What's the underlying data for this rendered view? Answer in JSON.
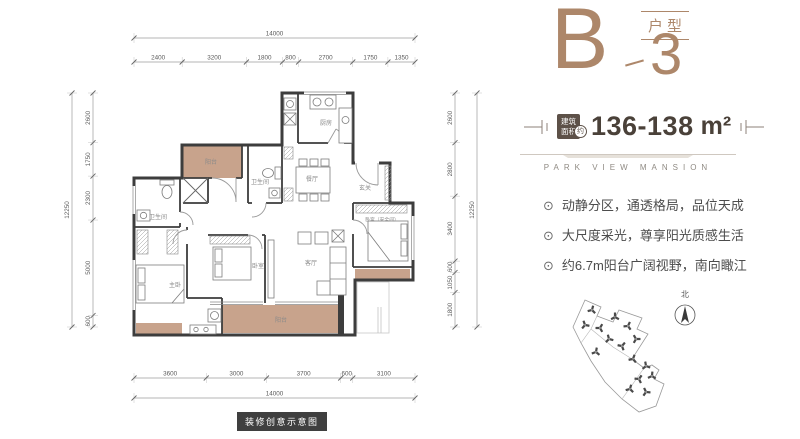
{
  "title": {
    "letter": "B",
    "number": "3",
    "type_label": "户型"
  },
  "area": {
    "badge_line1": "建筑",
    "badge_line2": "面积",
    "approx": "约",
    "value": "136-138",
    "unit": "m²"
  },
  "brand": {
    "name_en": "PARK VIEW MANSION"
  },
  "features": [
    "动静分区，通透格局，品位天成",
    "大尺度采光，尊享阳光质感生活",
    "约6.7m阳台广阔视野，南向瞰江"
  ],
  "icons": {
    "bullet": "⊙"
  },
  "compass": {
    "north_label": "北"
  },
  "footer": {
    "disclaimer": "装修创意示意图"
  },
  "colors": {
    "accent": "#ad876a",
    "balcony_fill": "#c8a38c",
    "wall": "#3d3d3d",
    "dim_text": "#5a5a5a"
  },
  "floorplan": {
    "rooms": [
      {
        "id": "balcony-top",
        "label": "阳台"
      },
      {
        "id": "bath-left",
        "label": "卫生间"
      },
      {
        "id": "bath-mid",
        "label": "卫生间"
      },
      {
        "id": "kitchen",
        "label": "厨房"
      },
      {
        "id": "dining",
        "label": "餐厅"
      },
      {
        "id": "foyer",
        "label": "玄关"
      },
      {
        "id": "bedroom-safe",
        "label": "卧室（安全间）"
      },
      {
        "id": "living",
        "label": "客厅"
      },
      {
        "id": "bedroom",
        "label": "卧室"
      },
      {
        "id": "master-bedroom",
        "label": "主卧"
      },
      {
        "id": "balcony-bottom",
        "label": "阳台"
      }
    ],
    "dimensions": {
      "top": {
        "total": 14000,
        "segments": [
          2400,
          3200,
          1800,
          800,
          2700,
          1750,
          1350
        ]
      },
      "bottom": {
        "total": 14000,
        "segments": [
          3600,
          3000,
          3700,
          600,
          3100
        ]
      },
      "left": {
        "total": 12250,
        "segments": [
          2600,
          1750,
          2300,
          5000,
          600
        ]
      },
      "right": {
        "total": 12250,
        "segments": [
          2600,
          2800,
          3400,
          600,
          1050,
          1800
        ]
      }
    }
  }
}
